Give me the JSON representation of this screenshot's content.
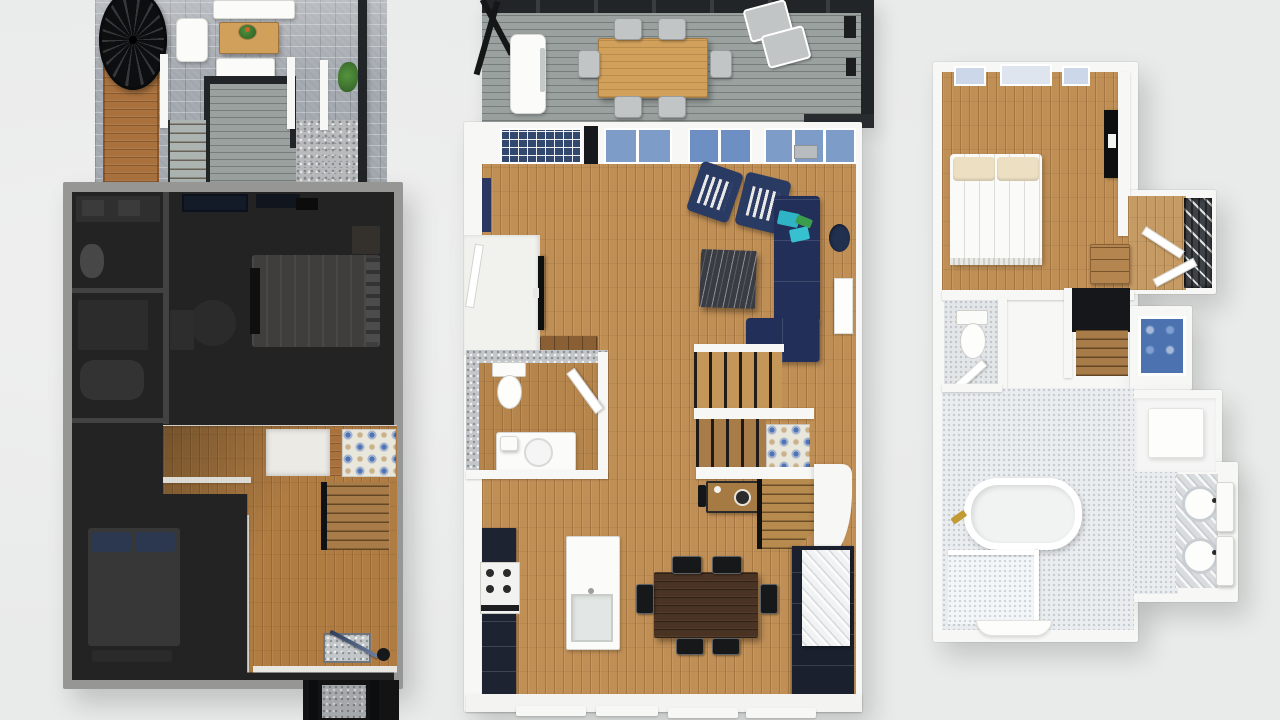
{
  "scene": {
    "type": "3d-floor-plan-render",
    "floors_visible": 3,
    "text_labels": [],
    "floors": [
      {
        "id": "floor-left",
        "state": "dimmed",
        "rooms": [
          "roof-patio",
          "bathroom-double-vanity",
          "shower-room",
          "primary-bedroom",
          "second-bedroom",
          "hallway-stairs",
          "tiled-entry",
          "entry-porch"
        ],
        "objects": [
          "spiral-staircase",
          "outdoor-sofa",
          "coffee-table-with-plant",
          "wood-walkway",
          "deck-with-railing",
          "gravel-bed",
          "planter",
          "bed",
          "bed-navy-pillows",
          "toilet",
          "double-sink-vanity",
          "staircase",
          "blue-pattern-tile",
          "doormat",
          "umbrella"
        ]
      },
      {
        "id": "floor-middle",
        "state": "highlighted",
        "rooms": [
          "rear-deck",
          "living-room",
          "entry-vestibule",
          "powder-room",
          "kitchen",
          "dining-area",
          "stair-hall"
        ],
        "objects": [
          "outdoor-dining-table",
          "six-outdoor-chairs",
          "two-lounge-chairs",
          "grill",
          "navy-armchair",
          "navy-armchair",
          "navy-sectional-sofa",
          "teal-pillows",
          "marble-coffee-table",
          "wall-niche",
          "fireplace",
          "tv",
          "media-console",
          "toilet",
          "vanity-sink",
          "staircase-up",
          "blue-tile-landing",
          "staircase-down",
          "desk",
          "kitchen-island-sink",
          "range",
          "navy-cabinets",
          "marble-counter",
          "dining-table",
          "six-black-chairs"
        ]
      },
      {
        "id": "floor-right",
        "state": "normal",
        "rooms": [
          "bedroom",
          "closet",
          "stair-hall",
          "water-closet",
          "primary-bathroom",
          "walk-in-closet",
          "vanity-nook"
        ],
        "objects": [
          "bed-white",
          "pillows",
          "tv",
          "dresser",
          "hanging-clothes",
          "bifold-doors",
          "staircase",
          "blue-tile-wall",
          "toilet",
          "freestanding-tub",
          "gold-faucet",
          "double-vanity-sinks",
          "marble-counter",
          "shower-glass"
        ]
      }
    ]
  },
  "palette": {
    "bg": "#e9eaea",
    "wallWhite": "#f7f7f5",
    "woodMain": "#c08f55",
    "woodLit": "#b07c42",
    "woodDeep": "#a87c48",
    "woodOutdoor": "#a9713d",
    "oak": "#d1a15c",
    "walnut": "#4a3322",
    "deckGray": "#9aa19f",
    "paver": "#a6abb1",
    "gravel": "#b8babb",
    "darkFrame": "#222527",
    "dimBase": "#232323",
    "dimWall": "#969695",
    "navy": "#223059",
    "navyChair": "#293a63",
    "teal": "#2fb4c5",
    "green": "#3a9e4e",
    "marbleDark": "#393d43",
    "glassBlue": "#7e9cc8",
    "glassDark": "#32486e",
    "glassPale": "#ccd8e9",
    "tileBlue": "#4c72b0",
    "tileBlueA": "#4f74b8",
    "cabinetNavy": "#1d2331",
    "penny": "#eaedef",
    "gold": "#c29b35",
    "closetDark": "#3d4246"
  }
}
